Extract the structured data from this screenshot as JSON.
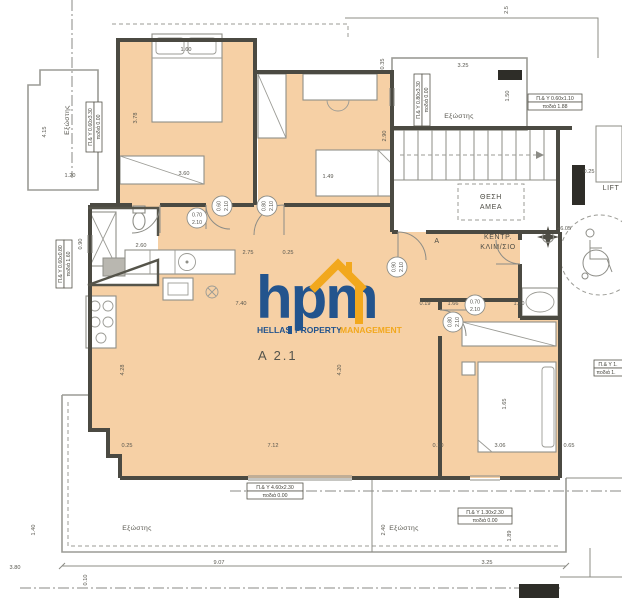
{
  "palette": {
    "floor": "#f6d0a5",
    "wall": "#4b4a42",
    "line": "#8c8c86",
    "logo_blue": "#1b4f8d",
    "logo_yellow": "#f2a718"
  },
  "unit": {
    "label": "A  2.1"
  },
  "watermark": {
    "brand": "hpm",
    "words": [
      "HELLAS",
      "PROPERTY",
      "MANAGEMENT"
    ]
  },
  "core": {
    "zone": "A",
    "amea_line1": "ΘΕΣΗ",
    "amea_line2": "ΑΜΕΑ",
    "central_line1": "ΚΕΝΤΡ.",
    "central_line2": "ΚΛΙΜ/ΣΙΟ",
    "lift": "LIFT",
    "level": "+6.05"
  },
  "balcony": {
    "label": "Εξώστης"
  },
  "window_tags": [
    {
      "l1": "Π.& Υ 0.60x3.30",
      "l2": "ποδιά 0.00"
    },
    {
      "l1": "Π.& Υ 0.60x0.80",
      "l2": "ποδιά 1.60"
    },
    {
      "l1": "Π.& Υ 0.80x3.30",
      "l2": "ποδιά 0.00"
    },
    {
      "l1": "Π.& Υ 0.60x1.10",
      "l2": "ποδιά 1.88"
    },
    {
      "l1": "Π.& Υ 4.60x2.30",
      "l2": "ποδιά 0.00"
    },
    {
      "l1": "Π.& Υ 1.30x2.30",
      "l2": "ποδιά 0.00"
    },
    {
      "l1": "Π.& Υ 1.",
      "l2": "ποδιά 1."
    }
  ],
  "door_tags": [
    {
      "w": "0.70",
      "h": "2.10"
    },
    {
      "w": "0.60",
      "h": "2.10"
    },
    {
      "w": "0.80",
      "h": "2.10"
    },
    {
      "w": "0.90",
      "h": "2.10"
    },
    {
      "w": "0.70",
      "h": "2.10"
    },
    {
      "w": "0.80",
      "h": "2.10"
    }
  ],
  "dims": [
    "3.78",
    "1.60",
    "3.60",
    "2.90",
    "1.49",
    "3.25",
    "1.50",
    "4.15",
    "1.20",
    "0.35",
    "2.75",
    "0.25",
    "2.60",
    "7.40",
    "4.28",
    "4.20",
    "7.12",
    "0.25",
    "0.10",
    "3.06",
    "0.65",
    "1.66",
    "1.90",
    "0.19",
    "1.65",
    "9.07",
    "3.25",
    "1.89",
    "1.40",
    "3.80",
    "0.10",
    "2.40",
    "0.25",
    "2.5",
    "0.90"
  ]
}
